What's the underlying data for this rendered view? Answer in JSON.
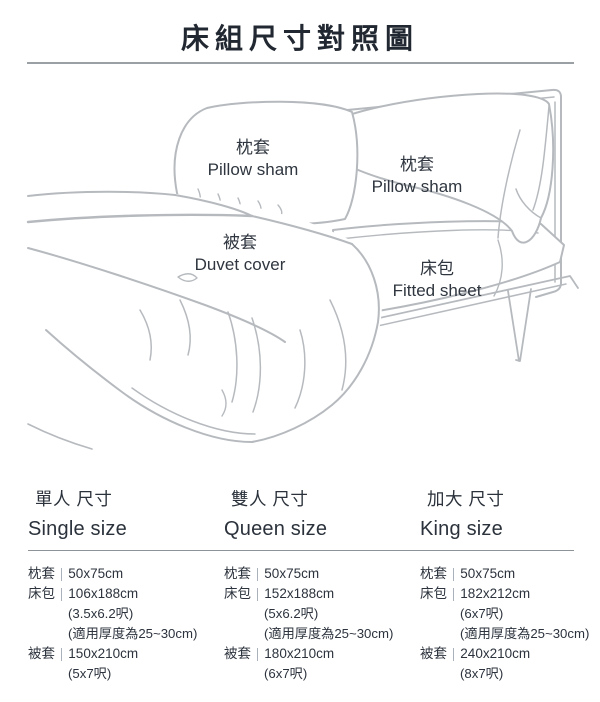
{
  "title": "床組尺寸對照圖",
  "diagram": {
    "pillow_left": {
      "zh": "枕套",
      "en": "Pillow sham"
    },
    "pillow_right": {
      "zh": "枕套",
      "en": "Pillow sham"
    },
    "duvet": {
      "zh": "被套",
      "en": "Duvet cover"
    },
    "fitted": {
      "zh": "床包",
      "en": "Fitted sheet"
    }
  },
  "sizes": [
    {
      "heading_zh": "單人 尺寸",
      "heading_en": "Single size",
      "rows": [
        {
          "label": "枕套",
          "value": "50x75cm"
        },
        {
          "label": "床包",
          "value": "106x188cm",
          "note1": "(3.5x6.2呎)",
          "note2": "(適用厚度為25~30cm)"
        },
        {
          "label": "被套",
          "value": "150x210cm",
          "note1": "(5x7呎)"
        }
      ]
    },
    {
      "heading_zh": "雙人 尺寸",
      "heading_en": "Queen size",
      "rows": [
        {
          "label": "枕套",
          "value": "50x75cm"
        },
        {
          "label": "床包",
          "value": "152x188cm",
          "note1": "(5x6.2呎)",
          "note2": "(適用厚度為25~30cm)"
        },
        {
          "label": "被套",
          "value": "180x210cm",
          "note1": "(6x7呎)"
        }
      ]
    },
    {
      "heading_zh": "加大 尺寸",
      "heading_en": "King size",
      "rows": [
        {
          "label": "枕套",
          "value": "50x75cm"
        },
        {
          "label": "床包",
          "value": "182x212cm",
          "note1": "(6x7呎)",
          "note2": "(適用厚度為25~30cm)"
        },
        {
          "label": "被套",
          "value": "240x210cm",
          "note1": "(8x7呎)"
        }
      ]
    }
  ],
  "colors": {
    "title_text": "#222831",
    "body_text": "#2c333d",
    "line_art": "#b6babe",
    "title_rule": "#9aa0a4",
    "section_rule": "#8d9397",
    "separator_bar": "#aab1ba"
  }
}
